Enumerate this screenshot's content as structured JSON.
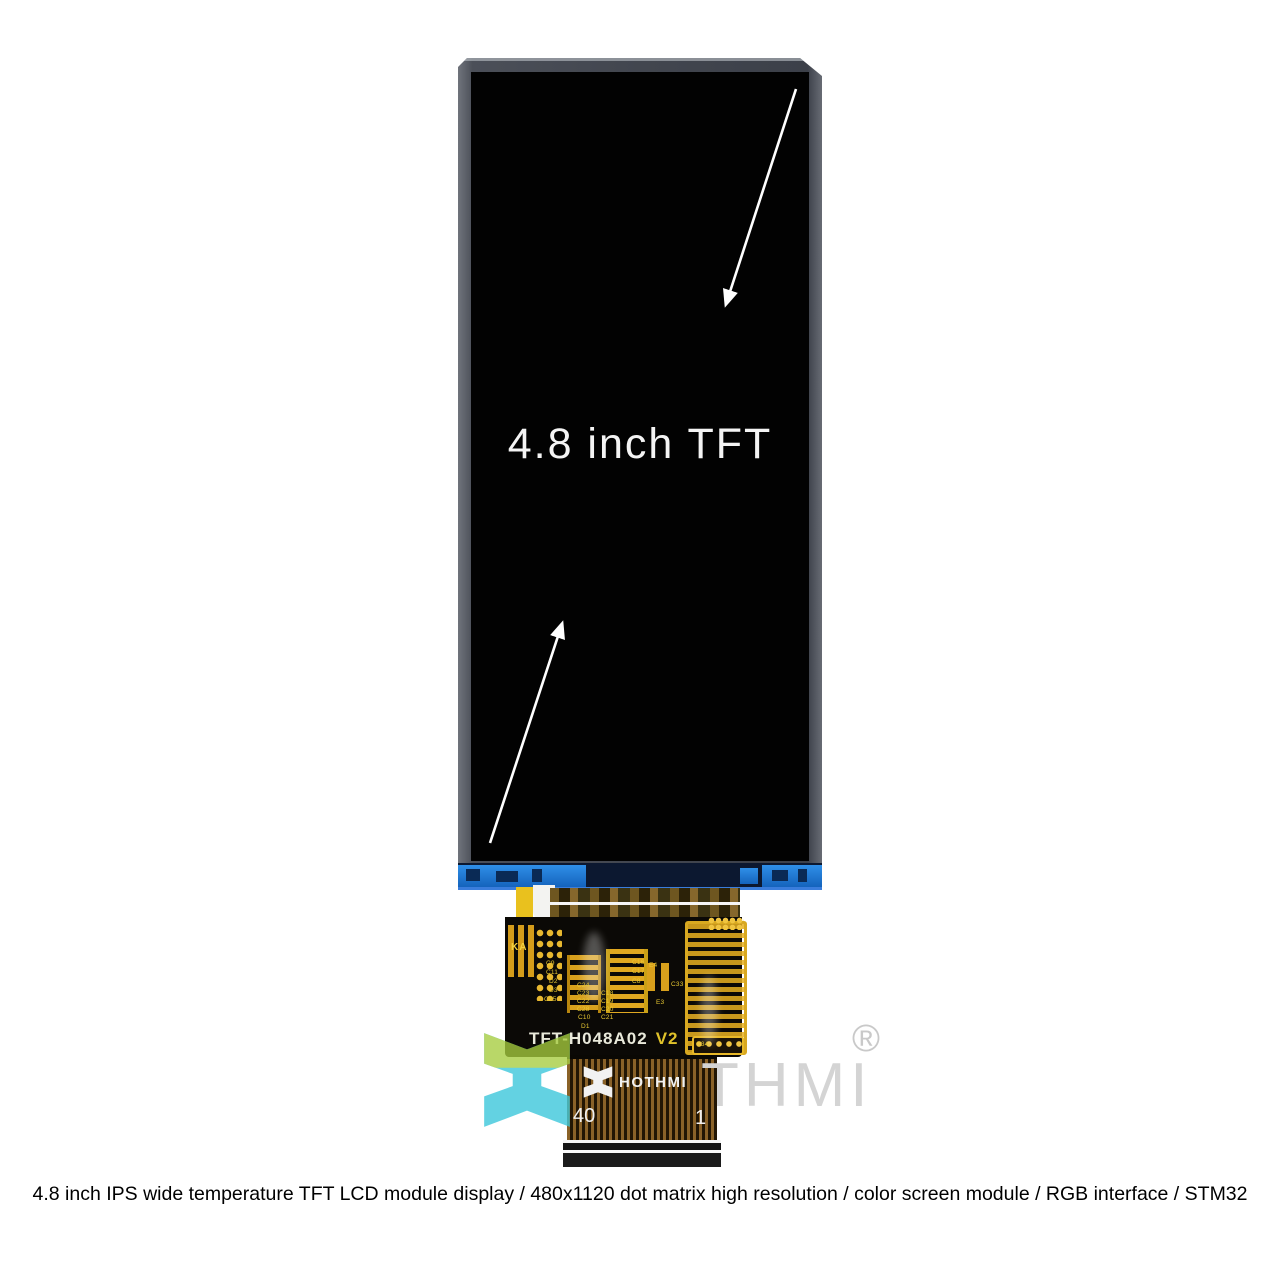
{
  "display": {
    "label": "4.8 inch TFT"
  },
  "pcb": {
    "model": "TFT-H048A02",
    "version": "V2",
    "marking": "KA",
    "components": [
      {
        "label": "C9",
        "x": 41,
        "y": 43
      },
      {
        "label": "C11",
        "x": 41,
        "y": 52
      },
      {
        "label": "D2",
        "x": 44,
        "y": 61
      },
      {
        "label": "D3",
        "x": 44,
        "y": 70
      },
      {
        "label": "C25",
        "x": 39,
        "y": 79
      },
      {
        "label": "C24",
        "x": 72,
        "y": 65
      },
      {
        "label": "C23",
        "x": 72,
        "y": 73
      },
      {
        "label": "C22",
        "x": 72,
        "y": 81
      },
      {
        "label": "C28",
        "x": 72,
        "y": 89
      },
      {
        "label": "C10",
        "x": 73,
        "y": 97
      },
      {
        "label": "C18",
        "x": 96,
        "y": 73
      },
      {
        "label": "C19",
        "x": 96,
        "y": 81
      },
      {
        "label": "C20",
        "x": 96,
        "y": 89
      },
      {
        "label": "C21",
        "x": 96,
        "y": 97
      },
      {
        "label": "D1",
        "x": 76,
        "y": 106
      },
      {
        "label": "C16",
        "x": 127,
        "y": 42
      },
      {
        "label": "C17",
        "x": 127,
        "y": 51
      },
      {
        "label": "C8",
        "x": 127,
        "y": 61
      },
      {
        "label": "E4",
        "x": 144,
        "y": 45
      },
      {
        "label": "C33",
        "x": 166,
        "y": 64
      },
      {
        "label": "E3",
        "x": 151,
        "y": 82
      },
      {
        "label": "C34",
        "x": 191,
        "y": 124
      }
    ]
  },
  "flex": {
    "brand": "HOTHMI",
    "pin_left": "40",
    "pin_right": "1"
  },
  "watermark": {
    "text": "THMI",
    "registered": "®"
  },
  "caption": "4.8 inch IPS wide temperature TFT LCD module display / 480x1120 dot matrix high resolution / color screen module / RGB interface / STM32",
  "colors": {
    "bezel_gray": "#42464f",
    "panel_blue": "#1f7ad6",
    "pcb_gold": "#d8a01c",
    "label_yellow": "#e8c832",
    "watermark_green": "#a6cc3e",
    "watermark_cyan": "#38c6da",
    "watermark_gray": "#d4d4d4"
  }
}
